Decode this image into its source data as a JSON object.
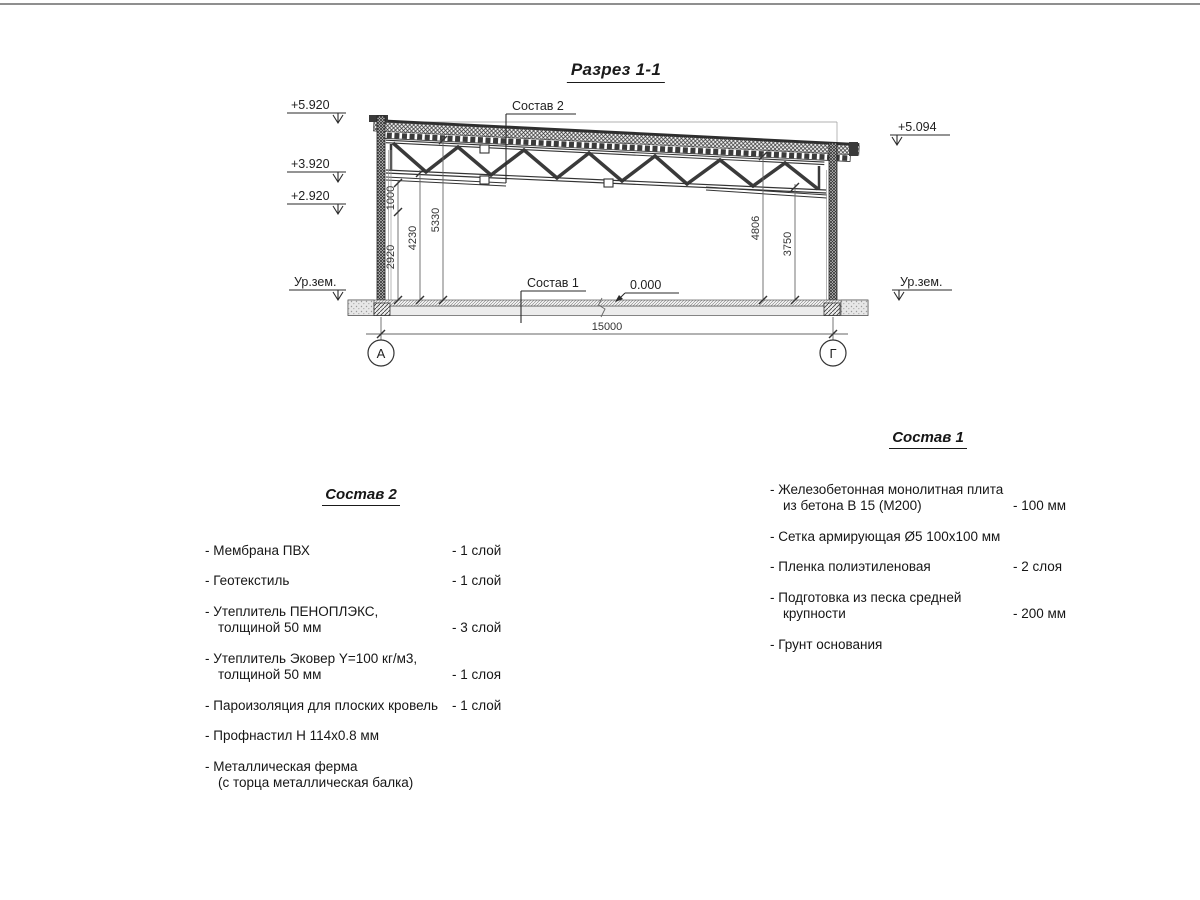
{
  "title": "Разрез 1-1",
  "drawing": {
    "labels": {
      "sostav2_leader": "Состав 2",
      "sostav1_leader": "Состав 1",
      "zero_mark": "0.000"
    },
    "elevations": {
      "left": [
        "+5.920",
        "+3.920",
        "+2.920"
      ],
      "ground_left": "Ур.зем.",
      "right": "+5.094",
      "ground_right": "Ур.зем."
    },
    "dimensions": {
      "v1000": "1000",
      "v2920": "2920",
      "v4230": "4230",
      "v5330": "5330",
      "v4806": "4806",
      "v3750": "3750",
      "span": "15000"
    },
    "axes": {
      "left": "А",
      "right": "Г"
    }
  },
  "sostav2": {
    "title": "Состав 2",
    "items": [
      {
        "lines": [
          "- Мембрана ПВХ"
        ],
        "value": "- 1 слой"
      },
      {
        "lines": [
          "- Геотекстиль"
        ],
        "value": "- 1 слой"
      },
      {
        "lines": [
          "- Утеплитель ПЕНОПЛЭКС,",
          "толщиной 50 мм"
        ],
        "value": "- 3 слой"
      },
      {
        "lines": [
          "- Утеплитель Эковер Y=100 кг/м3,",
          "толщиной 50 мм"
        ],
        "value": "- 1 слоя"
      },
      {
        "lines": [
          "- Пароизоляция для плоских кровель"
        ],
        "value": "- 1 слой"
      },
      {
        "lines": [
          "- Профнастил Н 114х0.8 мм"
        ],
        "value": ""
      },
      {
        "lines": [
          "- Металлическая ферма",
          "(с торца металлическая балка)"
        ],
        "value": ""
      }
    ]
  },
  "sostav1": {
    "title": "Состав 1",
    "items": [
      {
        "lines": [
          "- Железобетонная  монолитная плита",
          "из бетона В 15 (М200)"
        ],
        "value": "- 100 мм"
      },
      {
        "lines": [
          "- Сетка армирующая Ø5 100х100 мм"
        ],
        "value": ""
      },
      {
        "lines": [
          "- Пленка полиэтиленовая"
        ],
        "value": "-  2 слоя"
      },
      {
        "lines": [
          "- Подготовка из песка средней",
          "крупности"
        ],
        "value": "- 200 мм"
      },
      {
        "lines": [
          "- Грунт основания"
        ],
        "value": ""
      }
    ]
  }
}
